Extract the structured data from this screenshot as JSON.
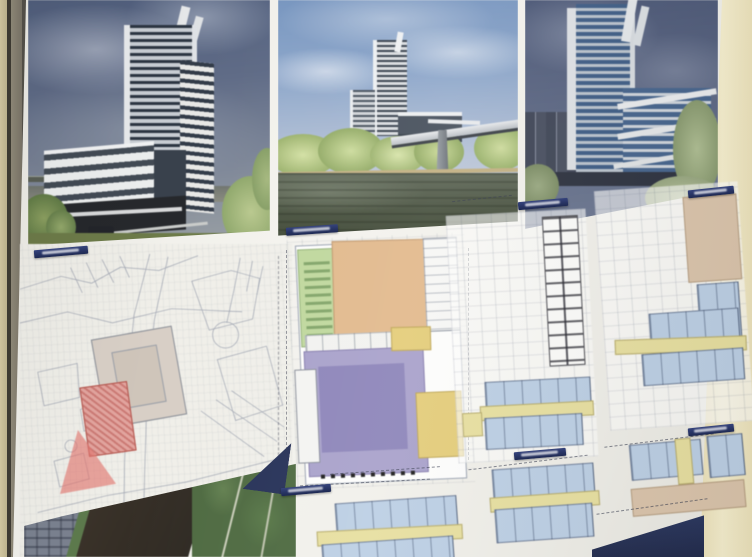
{
  "image": {
    "kind": "photograph",
    "subject": "architectural presentation board on a wall, photographed at an angle"
  },
  "board": {
    "renders": [
      {
        "id": "render-left",
        "subject": "3D rendering: high-rise tower with striped office slab, street level view, dark cloudy sky"
      },
      {
        "id": "render-middle",
        "subject": "3D rendering: tower complex seen across a river with road bridge and wooded bank"
      },
      {
        "id": "render-right",
        "subject": "3D rendering: close-up of glass tower with white bands and low wing, trees below"
      }
    ],
    "drawings": [
      {
        "id": "site-plan",
        "title": ""
      },
      {
        "id": "ground-floor-plan",
        "title": ""
      },
      {
        "id": "floor-plan-upper-1",
        "title": ""
      },
      {
        "id": "floor-plan-upper-2",
        "title": ""
      },
      {
        "id": "floor-plan-lower-1",
        "title": ""
      },
      {
        "id": "floor-plan-lower-2",
        "title": ""
      },
      {
        "id": "floor-plan-lower-3",
        "title": ""
      }
    ],
    "colors": {
      "paper": "#f2f1ec",
      "title_bar_navy": "#253168",
      "wall_beige": "#efe6c0",
      "frame_gray": "#8a English847a",
      "sky_left": "#54617e",
      "sky_middle": "#7f9cc4",
      "sky_right": "#4f5b7a",
      "water": "#4b5442",
      "foliage_green": "#8ca061",
      "plan_zone_green": "#c0d89e",
      "plan_zone_orange": "#e2ba8e",
      "plan_zone_purple": "#a9a2cb",
      "plan_zone_yellow": "#e4cd7b",
      "room_blue": "#bccfe4",
      "corridor_yellow": "#e7dfa0",
      "zone_tan": "#dac4ab",
      "site_highlight_pink": "#e2a49e",
      "aerial_river": "#2e2922",
      "aerial_forest": "#4e6a41",
      "navy_band": "#2d3a63"
    }
  }
}
